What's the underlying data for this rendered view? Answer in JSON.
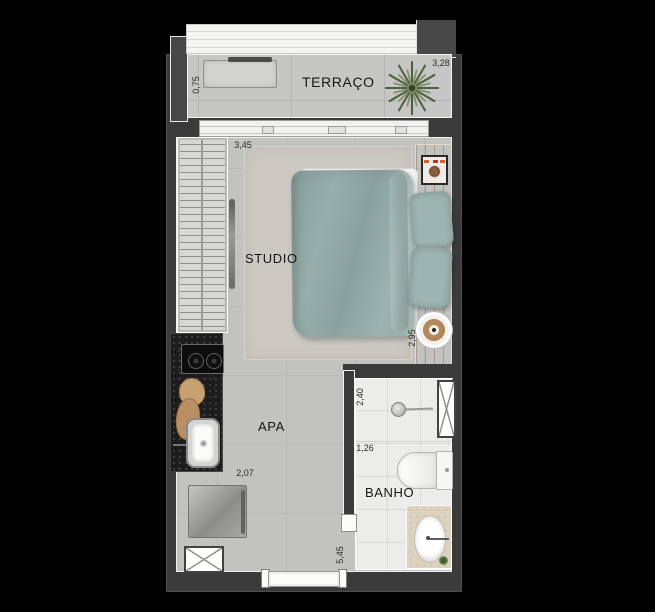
{
  "plan_title": "studio floor plan",
  "rooms": {
    "terraco": "TERRAÇO",
    "studio": "STUDIO",
    "apa": "APA",
    "banho": "BANHO"
  },
  "dims": {
    "terrace_depth": "0,75",
    "terrace_width": "3,28",
    "studio_width": "3,45",
    "studio_depth": "2,95",
    "kitchen_run": "2,07",
    "banho_depth": "2,40",
    "banho_width": "1,26",
    "apto_depth": "5,45"
  },
  "colors": {
    "background": "#000000",
    "wall": "#3b3b3b",
    "terrace_floor": "#c6c6c4",
    "studio_floor": "#c2c2c0",
    "bath_floor": "#ececea",
    "wood": "#cba47a",
    "textile_sage": "#93aaa6",
    "counter_granite": "#1c1c1c",
    "plant_green": "#5c6e4e"
  }
}
